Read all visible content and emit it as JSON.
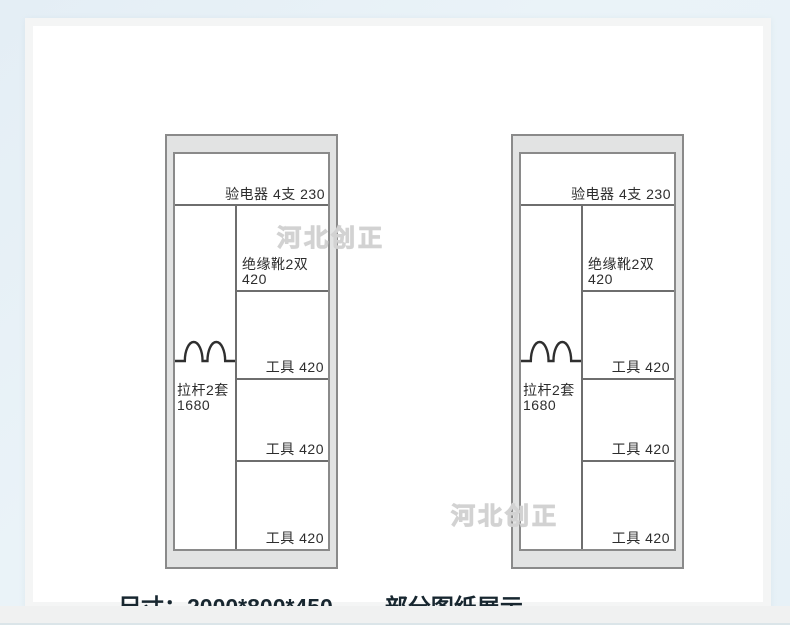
{
  "page": {
    "background_color": "#e9f2f7",
    "watermark_text": "河北创正"
  },
  "caption": {
    "dimensions": "尺寸：2000*800*450",
    "note": "部分图纸展示"
  },
  "diagram": {
    "cabinets": [
      {
        "name": "cabinet-left",
        "top_shelf_label": "验电器 4支 230",
        "left_compartment": {
          "symbol": "pull-rod-hooks",
          "label_line1": "拉杆2套",
          "label_line2": "1680"
        },
        "right_compartments": [
          {
            "label_line1": "绝缘靴2双",
            "label_line2": "420"
          },
          {
            "label": "工具 420"
          },
          {
            "label": "工具 420"
          },
          {
            "label": "工具 420"
          }
        ]
      },
      {
        "name": "cabinet-right",
        "top_shelf_label": "验电器 4支 230",
        "left_compartment": {
          "symbol": "pull-rod-hooks",
          "label_line1": "拉杆2套",
          "label_line2": "1680"
        },
        "right_compartments": [
          {
            "label_line1": "绝缘靴2双",
            "label_line2": "420"
          },
          {
            "label": "工具 420"
          },
          {
            "label": "工具 420"
          },
          {
            "label": "工具 420"
          }
        ]
      }
    ]
  },
  "colors": {
    "cabinet_frame_fill": "#e2e3e3",
    "cabinet_border": "#8a8a8a",
    "divider_line": "#6e6e6e",
    "label_text": "#2d2d2d",
    "caption_text": "#182730",
    "watermark_outline": "#d2d2d2"
  }
}
